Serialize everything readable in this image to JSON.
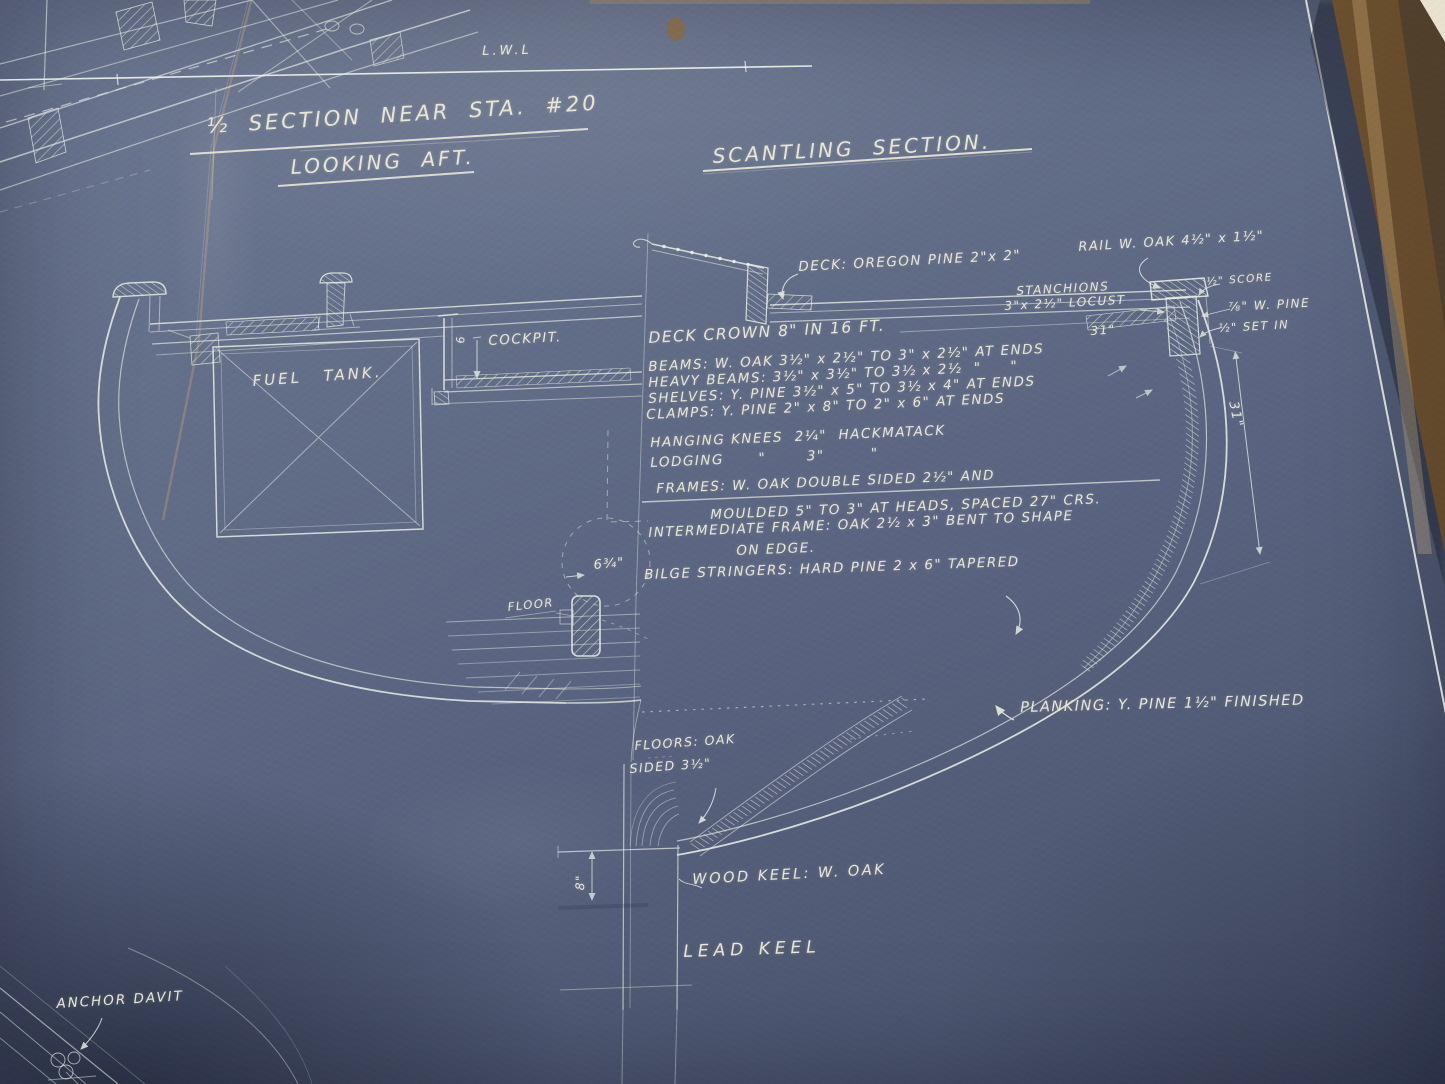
{
  "photo": {
    "background_blue": "#5d6780",
    "ink_white": "#e9ede4",
    "lettering_cream": "#eae7d5",
    "frame_wood_brown": "#86663c",
    "mat_cream": "#e9e2cf",
    "crease_tan": "#bfa276"
  },
  "titles": {
    "section_line1": "½ SECTION NEAR STA. #20",
    "section_line2": "LOOKING AFT.",
    "scantling": "SCANTLING SECTION."
  },
  "waterline_label": "L.W.L",
  "left_section": {
    "fuel_tank": "FUEL TANK.",
    "cockpit": "COCKPIT.",
    "cockpit_dim": "9",
    "floor_label": "FLOOR",
    "bilge_stringer_dim": "6¾\"",
    "anchor_davit": "ANCHOR DAVIT"
  },
  "scantling_section": {
    "rail": "RAIL W. OAK 4½\" x 1½\"",
    "score": "½\" SCORE",
    "deck": "DECK: OREGON PINE 2\"x 2\"",
    "stanchions_line1": "STANCHIONS",
    "stanchions_line2": "3\"x 2½\" LOCUST",
    "white_pine": "⅞\" W. PINE",
    "set_in": "½\" SET IN",
    "deck_edge_dim": "31\"",
    "topside_dim": "31\"",
    "deck_crown": "DECK CROWN 8\" IN 16 FT.",
    "beams": "BEAMS: W. OAK 3½\" x 2½\" TO 3\" x 2½\" AT ENDS",
    "heavy_beams": "HEAVY BEAMS: 3½\" x 3½\" TO 3½ x 2½  \"     \"",
    "shelves": "SHELVES: Y. PINE 3½\" x 5\" TO 3½ x 4\" AT ENDS",
    "clamps": "CLAMPS: Y. PINE 2\" x 8\" TO 2\" x 6\" AT ENDS",
    "hanging_knees": "HANGING KNEES  2¼\"  HACKMATACK",
    "lodging_knees": "LODGING      \"       3\"        \"",
    "frames_line1": "FRAMES: W. OAK DOUBLE SIDED 2½\" AND",
    "frames_line2": "MOULDED 5\" TO 3\" AT HEADS, SPACED 27\" CRS.",
    "intermediate_line1": "INTERMEDIATE FRAME: OAK 2½ x 3\" BENT TO SHAPE",
    "intermediate_line2": "ON EDGE.",
    "bilge_stringers": "BILGE STRINGERS: HARD PINE 2 x 6\" TAPERED",
    "planking": "PLANKING: Y. PINE 1½\" FINISHED",
    "floors_line1": "FLOORS: OAK",
    "floors_line2": "SIDED 3½\"",
    "wood_keel": "WOOD KEEL: W. OAK",
    "lead_keel": "LEAD KEEL",
    "keel_depth_dim": "8\""
  }
}
